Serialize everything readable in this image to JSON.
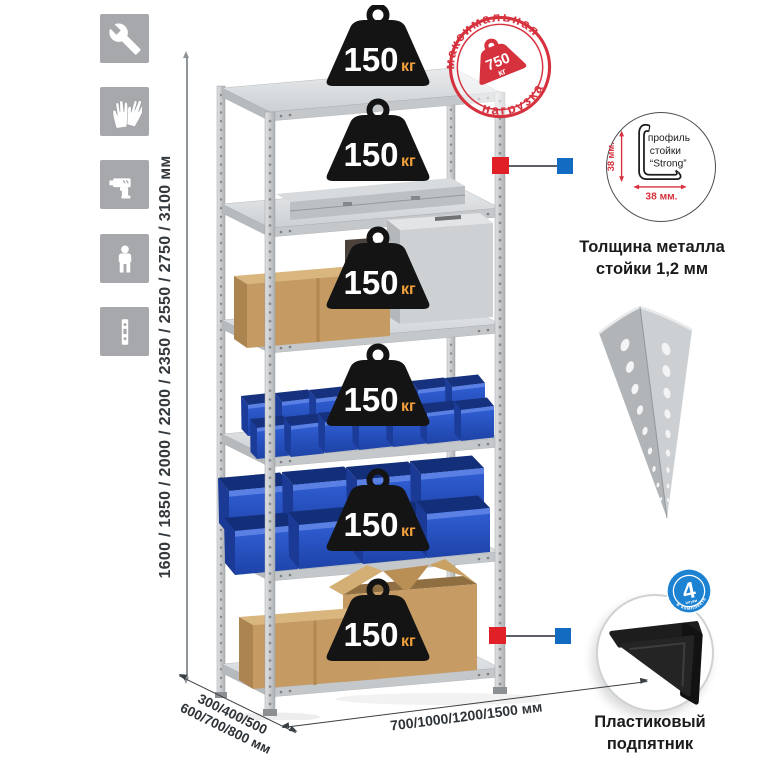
{
  "colors": {
    "stamp_red": "#d6323e",
    "callout_red": "#e01f26",
    "callout_blue": "#146cc2",
    "badge_blue": "#1e82d2",
    "bin_blue": "#2a54c4",
    "icon_bg": "#a6a8ab"
  },
  "sidebar": {
    "icons": [
      {
        "name": "wrench-icon"
      },
      {
        "name": "gloves-icon"
      },
      {
        "name": "drill-icon"
      },
      {
        "name": "person-icon"
      },
      {
        "name": "post-profile-icon"
      }
    ]
  },
  "dimensions": {
    "height_options": "1600 / 1850 / 2000 / 2200 / 2350 / 2550 / 2750 / 3100 мм",
    "depth_options_line1": "300/400/500",
    "depth_options_line2": "600/700/800 мм",
    "width_options": "700/1000/1200/1500 мм"
  },
  "rack": {
    "shelves_count": 6,
    "shelf_load_value": "150",
    "shelf_load_unit": "кг",
    "shelf_loads": [
      "150 кг",
      "150 кг",
      "150 кг",
      "150 кг",
      "150 кг",
      "150 кг"
    ]
  },
  "max_load_stamp": {
    "arc_top": "максимальная",
    "arc_bottom": "нагрузка",
    "value": "750",
    "unit": "кг"
  },
  "profile_callout": {
    "height_dim": "38 мм.",
    "width_dim": "38 мм.",
    "label_line1": "профиль",
    "label_line2": "стойки",
    "label_line3": "“Strong”",
    "caption_line1": "Толщина металла",
    "caption_line2": "стойки 1,2 мм"
  },
  "foot_callout": {
    "badge_count": "4",
    "badge_small": "штуки",
    "badge_arc": "в комплекте",
    "caption_line1": "Пластиковый",
    "caption_line2": "подпятник"
  }
}
